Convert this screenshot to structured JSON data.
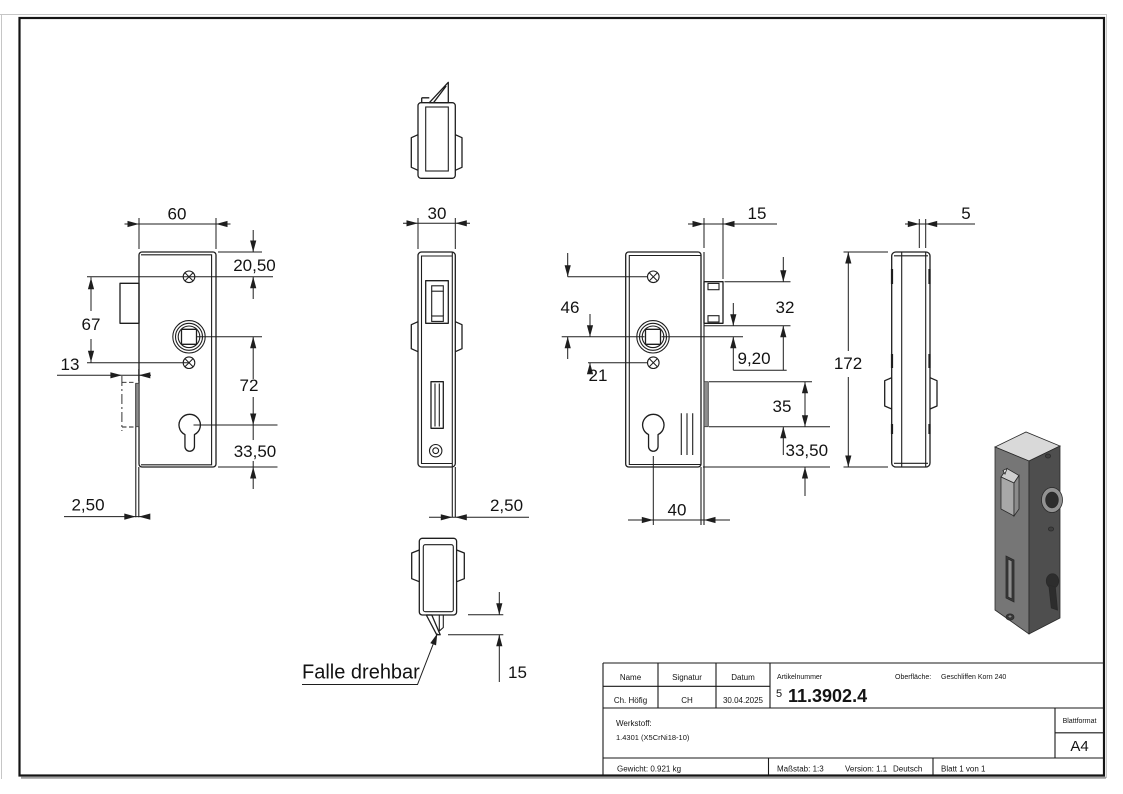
{
  "dims": {
    "front_width": "60",
    "front_top": "20,50",
    "front_screws": "67",
    "front_latch": "13",
    "front_span": "72",
    "front_bottom": "33,50",
    "front_plate": "2,50",
    "side_width": "30",
    "side_plate": "2,50",
    "side_latch": "15",
    "back_latch_depth": "15",
    "back_screw_to_spindle": "46",
    "back_spindle_to_screw": "21",
    "back_latch_height": "32",
    "back_spindle_offset": "9,20",
    "back_bolt_height": "35",
    "back_bolt_bottom": "33,50",
    "back_cylinder_x": "40",
    "profile_thickness": "5",
    "profile_height": "172"
  },
  "note": {
    "latch": "Falle drehbar"
  },
  "title_block": {
    "col_name": "Name",
    "col_signature": "Signatur",
    "col_date": "Datum",
    "name": "Ch. Höfig",
    "signature": "CH",
    "date": "30.04.2025",
    "article_label": "Artikelnummer",
    "article_prefix": "5",
    "article_number": "11.3902.4",
    "surface_label": "Oberfläche:",
    "surface_value": "Geschliffen Korn 240",
    "material_label": "Werkstoff:",
    "material_value": "1.4301 (X5CrNi18-10)",
    "format_label": "Blattformat",
    "format_value": "A4",
    "weight": "Gewicht: 0.921 kg",
    "scale": "Maßstab: 1:3",
    "version": "Version: 1.1",
    "language": "Deutsch",
    "sheet": "Blatt 1 von 1"
  }
}
